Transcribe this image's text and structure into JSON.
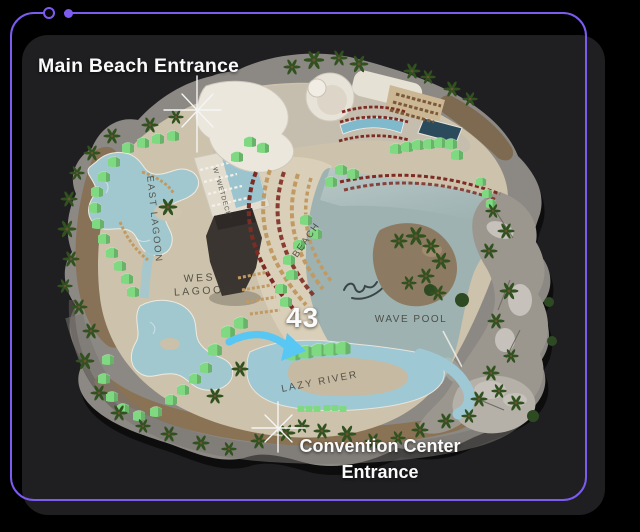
{
  "frame": {
    "border_color": "#7D5BF0"
  },
  "overlay": {
    "main_entrance_label": "Main Beach Entrance",
    "count_label": "43",
    "convention_label_line1": "Convention Center",
    "convention_label_line2": "Entrance",
    "arrow_color": "#59C7F3",
    "marker_color": "#F5F5F5"
  },
  "map": {
    "labels": {
      "east_lagoon": "EAST LAGOON",
      "wetdeck": "W \"WETDECK\"",
      "west_lagoon_line1": "WEST",
      "west_lagoon_line2": "LAGOON",
      "beach": "BEACH",
      "wave_pool": "WAVE POOL",
      "lazy_river": "LAZY RIVER"
    },
    "colors": {
      "sand": "#CDC2AB",
      "lagoon_water": "#A2C8CF",
      "wave_pool_water": "#9DB2B1",
      "lazy_river_water": "#9FC8D5",
      "cabana_green": "#7FD981",
      "chair_red": "#7E2B24",
      "chair_tan": "#C09A62",
      "palm_green": "#31511F",
      "label_ink": "#3C3A31"
    }
  }
}
